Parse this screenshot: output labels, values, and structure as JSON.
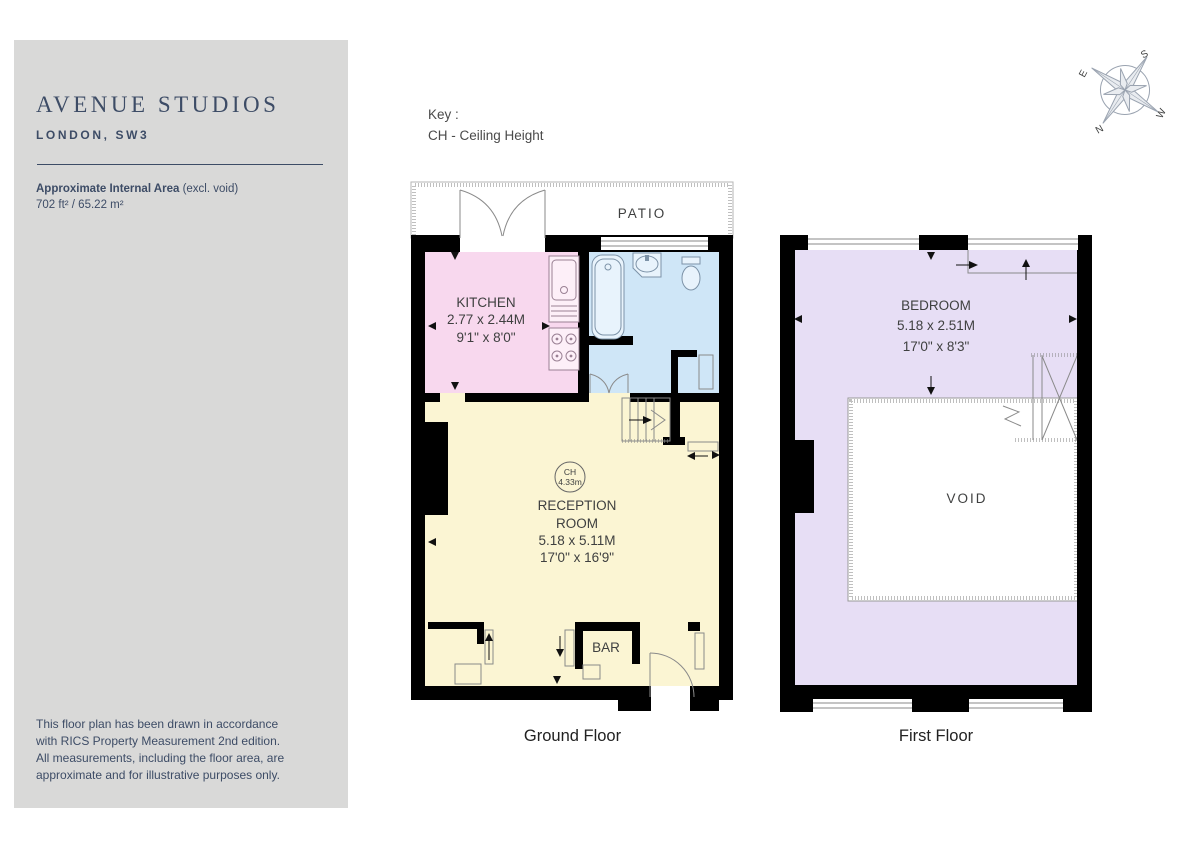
{
  "colors": {
    "page_bg": "#ffffff",
    "sidebar_bg": "#d9d9d8",
    "accent_navy": "#3d4c66",
    "plan_text": "#3f4040",
    "wall": "#000000",
    "line_gray": "#8a8a8a",
    "kitchen_fill": "#f8d8ee",
    "bathroom_fill": "#cfe6f7",
    "reception_fill": "#fbf5d3",
    "bedroom_fill": "#e7def5",
    "compass_stroke": "#9aa3b0"
  },
  "sidebar": {
    "title": "AVENUE STUDIOS",
    "subtitle": "LONDON, SW3",
    "area_label": "Approximate Internal Area",
    "area_note": " (excl. void)",
    "area_value": "702 ft² / 65.22 m²",
    "disclaimer_lines": [
      "This floor plan has been drawn in accordance",
      "with RICS Property Measurement 2nd edition.",
      "All measurements, including the floor area, are",
      "approximate and for illustrative purposes only."
    ]
  },
  "key": {
    "title": "Key :",
    "entry": "CH - Ceiling Height"
  },
  "compass": {
    "n": "N",
    "e": "E",
    "s": "S",
    "w": "W"
  },
  "ground_floor": {
    "caption": "Ground Floor",
    "patio_label": "PATIO",
    "bar_label": "BAR",
    "kitchen": {
      "name": "KITCHEN",
      "metric": "2.77 x 2.44M",
      "imperial": "9'1\" x 8'0\""
    },
    "reception": {
      "line1": "RECEPTION",
      "line2": "ROOM",
      "metric": "5.18 x 5.11M",
      "imperial": "17'0\" x 16'9\"",
      "ch_label": "CH",
      "ch_value": "4.33m"
    }
  },
  "first_floor": {
    "caption": "First Floor",
    "void_label": "VOID",
    "bedroom": {
      "name": "BEDROOM",
      "metric": "5.18 x 2.51M",
      "imperial": "17'0\" x 8'3\""
    }
  }
}
